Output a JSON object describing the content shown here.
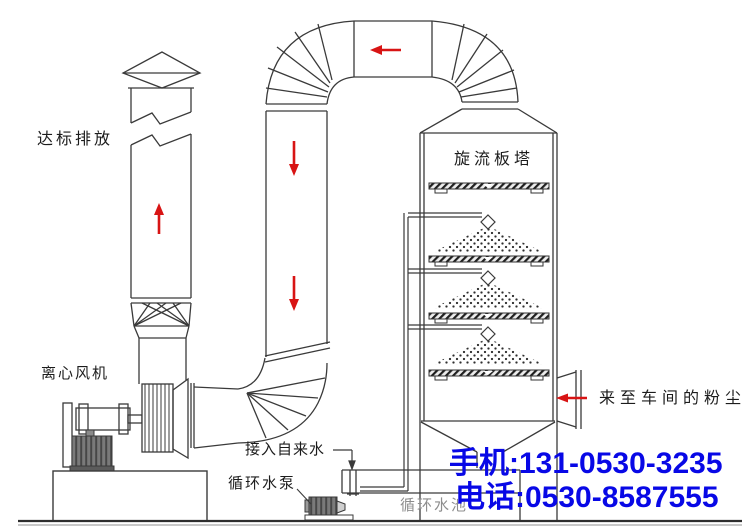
{
  "diagram": {
    "title_hint": "cyclone-plate-tower dust scrubbing system process drawing",
    "labels": {
      "emission": "达标排放",
      "fan": "离心风机",
      "tower": "旋流板塔",
      "dust_inlet": "来至车间的粉尘",
      "tap_water": "接入自来水",
      "pump": "循环水泵",
      "pool": "循环水池"
    },
    "contact": {
      "mobile": "手机:131-0530-3235",
      "phone": "电话:0530-8587555"
    },
    "colors": {
      "line": "#3a3a3a",
      "flow_arrow_red": "#d81414",
      "contact_blue": "#0808e6",
      "pool_label_gray": "#8d8d8d",
      "motor_gray": "#7a7a7a"
    },
    "flow_arrows": [
      {
        "name": "chimney-up-arrow",
        "direction": "up"
      },
      {
        "name": "top-duct-left-arrow",
        "direction": "left"
      },
      {
        "name": "down-duct-arrow-1",
        "direction": "down"
      },
      {
        "name": "down-duct-arrow-2",
        "direction": "down"
      },
      {
        "name": "dust-inlet-arrow",
        "direction": "left"
      }
    ]
  }
}
